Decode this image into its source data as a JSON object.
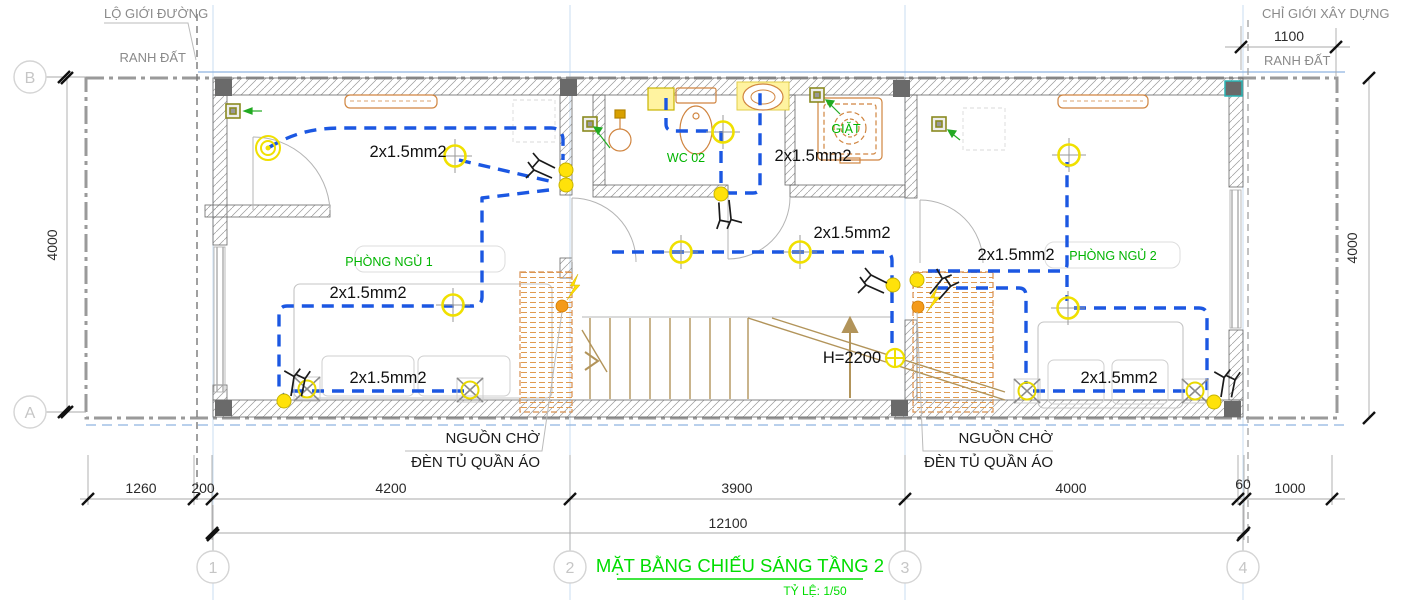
{
  "title": {
    "text": "MẶT BẰNG CHIẾU SÁNG TẦNG 2",
    "scale_label": "TỶ LỆ: 1/50"
  },
  "annotations": {
    "road_boundary": "LỘ GIỚI ĐƯỜNG",
    "construction_boundary": "CHỈ GIỚI XÂY DỰNG",
    "land_boundary_left": "RANH ĐẤT",
    "land_boundary_right": "RANH ĐẤT",
    "wardrobe_note_line1": "NGUỒN CHỜ",
    "wardrobe_note_line2": "ĐÈN TỦ QUẦN ÁO"
  },
  "grid": {
    "row_b": "B",
    "row_a": "A",
    "col_1": "1",
    "col_2": "2",
    "col_3": "3",
    "col_4": "4"
  },
  "dimensions": {
    "top_offset": "1100",
    "side_left": "4000",
    "side_right": "4000",
    "bottom": [
      "1260",
      "200",
      "4200",
      "3900",
      "4000",
      "60",
      "1000"
    ],
    "overall": "12100"
  },
  "rooms": {
    "bedroom1": "PHÒNG NGỦ 1",
    "bedroom2": "PHÒNG NGỦ 2",
    "wc": "WC 02",
    "laundry": "GIẶT"
  },
  "wiring": {
    "conduit_label": "2x1.5mm2",
    "stair_headroom": "H=2200"
  },
  "symbols": {
    "ceiling_light": "yellow circle with crosshair",
    "wall_light": "yellow circle with X",
    "switch": "black fork symbol",
    "power_point": "yellow dot",
    "waiting_source": "orange dot"
  },
  "colors": {
    "wire_blue": "#1b57e2",
    "light_yellow": "#f0e000",
    "label_green": "#00b400",
    "title_green": "#00dd00",
    "furniture_orange": "#d08540",
    "stair_tan": "#b2945a"
  }
}
